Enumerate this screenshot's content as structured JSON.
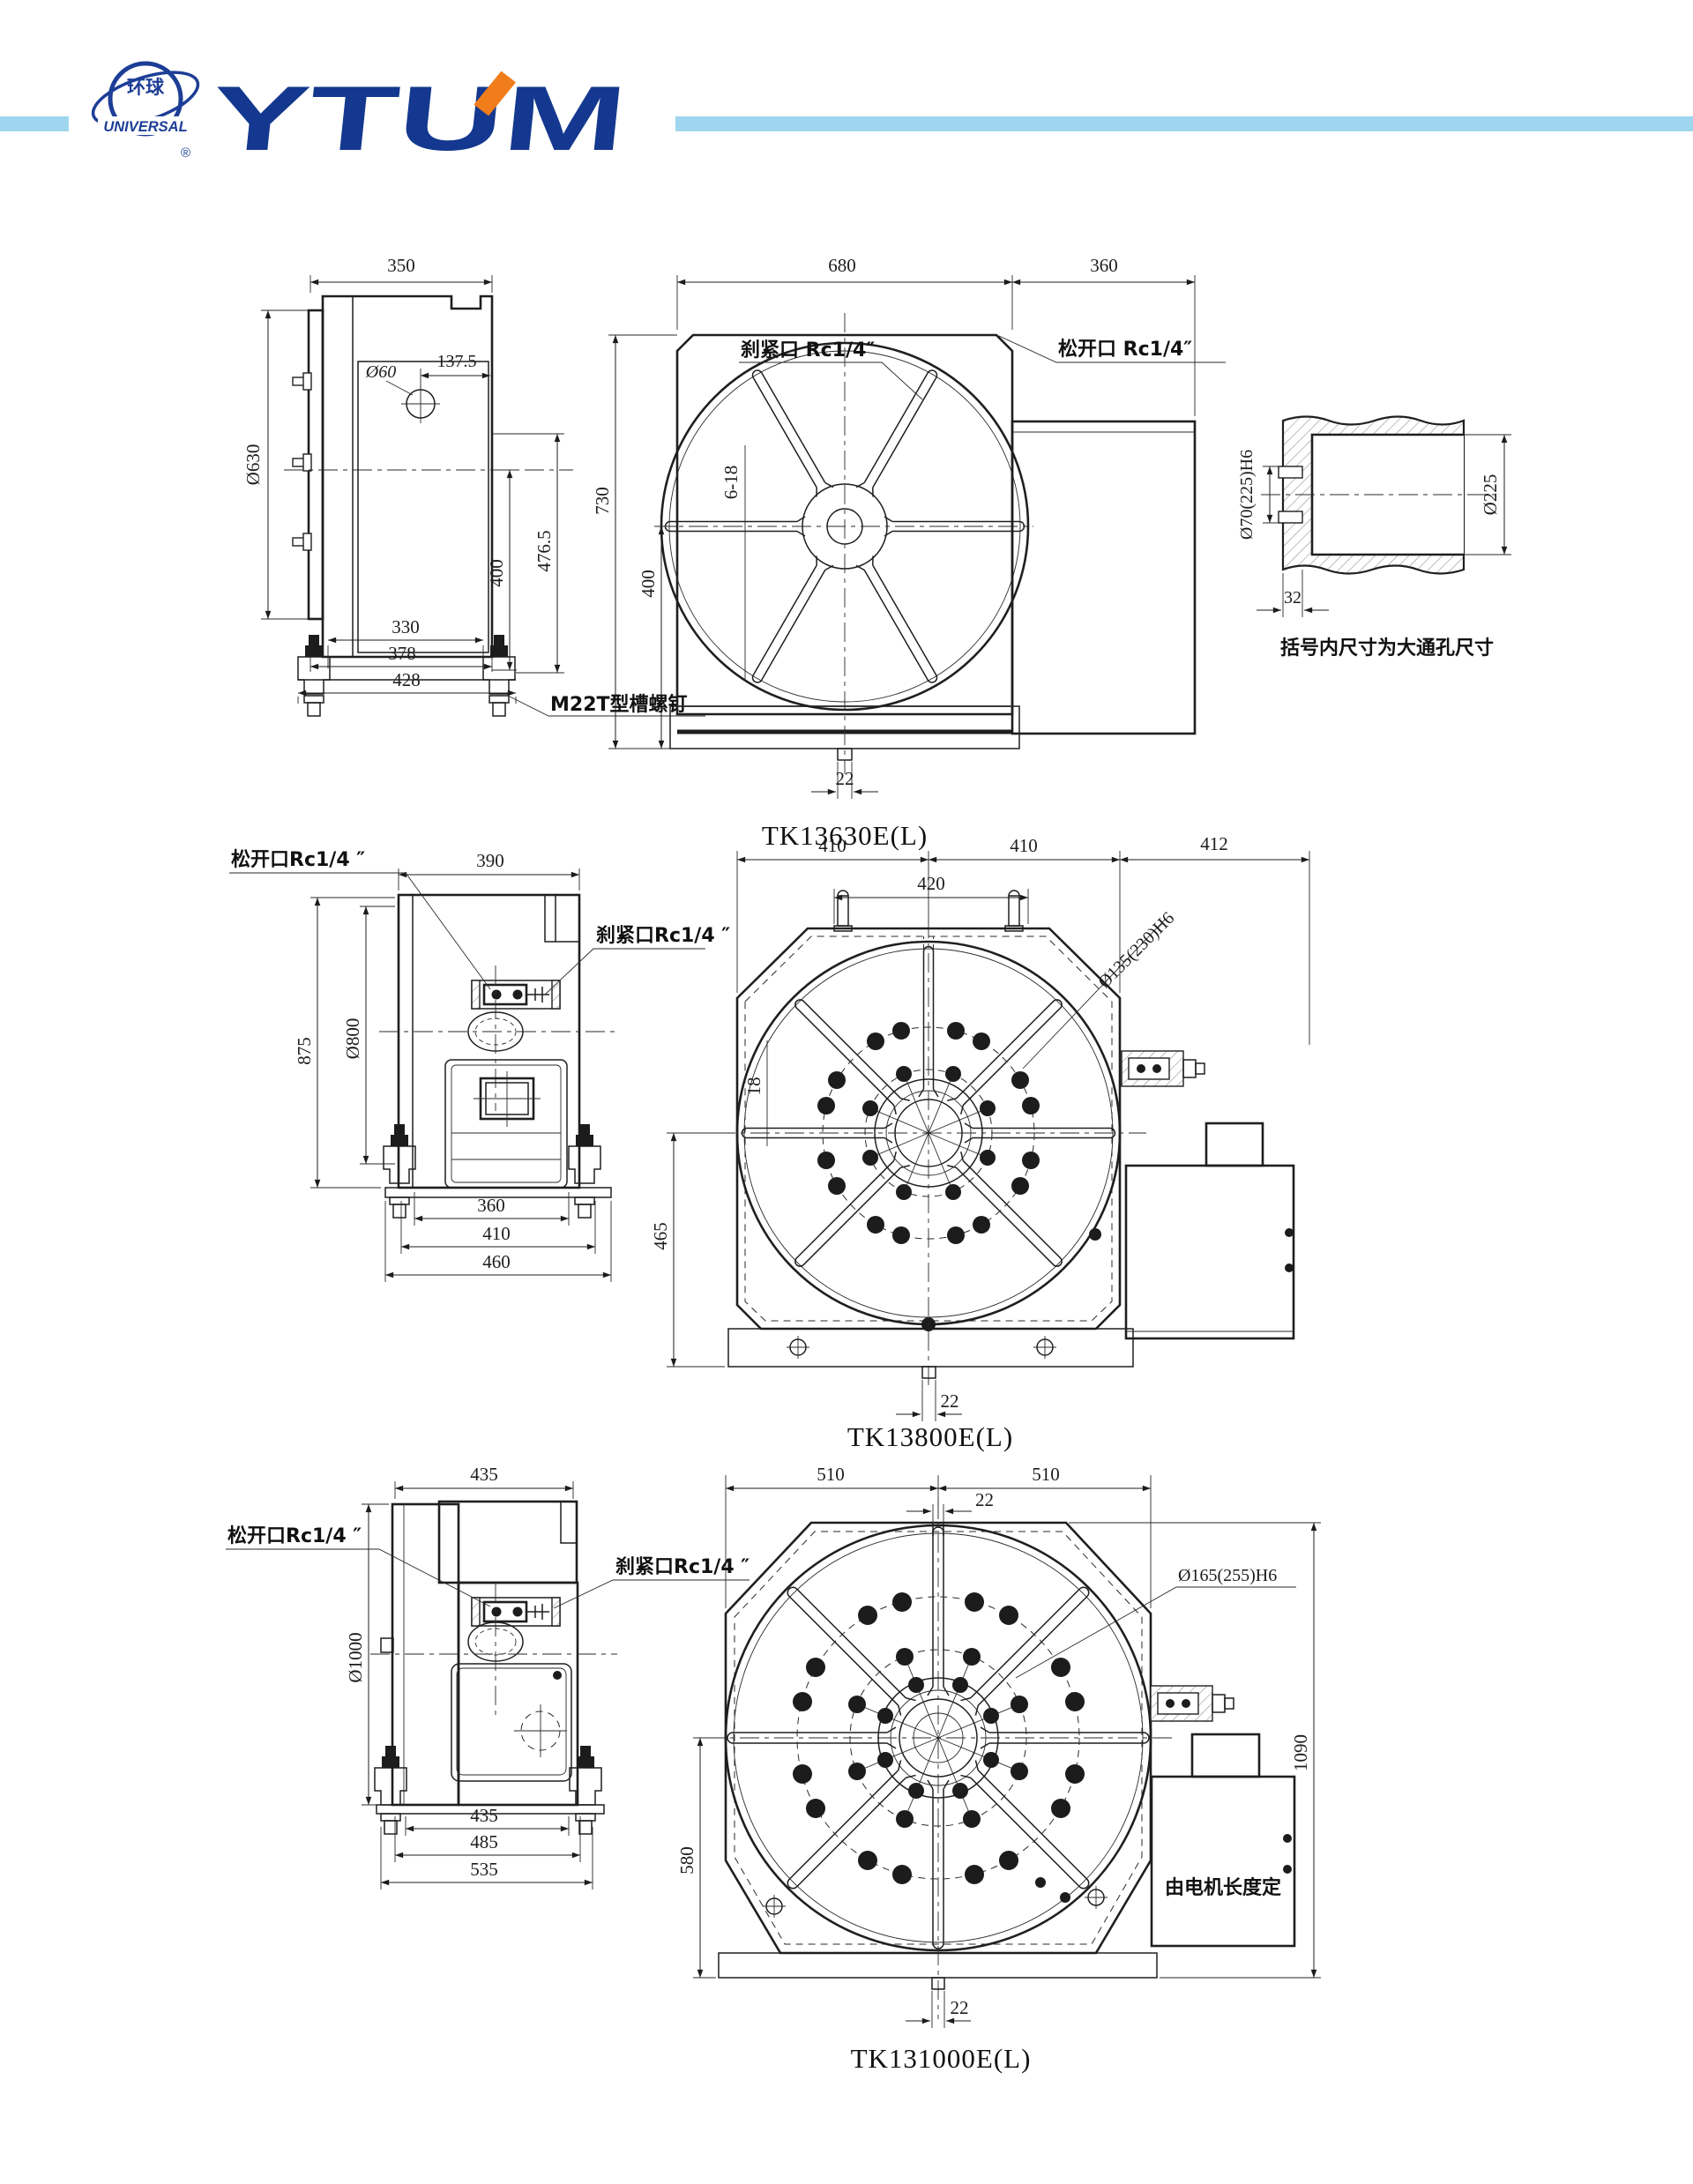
{
  "header": {
    "cn": "环球",
    "en": "UNIVERSAL",
    "reg": "®",
    "brand": "YTUM",
    "accent_blue": "#14388f",
    "accent_orange": "#f07c1a",
    "bar_color": "#9fd6ef"
  },
  "note": "括号内尺寸为大通孔尺寸",
  "d1": {
    "title": "TK13630E(L)",
    "s_w": "350",
    "s_dia": "Ø630",
    "s_off": "137.5",
    "s_bore": "Ø60",
    "s_h400": "400",
    "s_h476": "476.5",
    "s_b330": "330",
    "s_b378": "378",
    "s_b428": "428",
    "s_screw": "M22T型槽螺钉",
    "f_w680": "680",
    "f_w360": "360",
    "f_slots": "6-18",
    "f_h730": "730",
    "f_h400": "400",
    "f_s22": "22",
    "f_brake": "刹紧口 Rc1/4″",
    "f_release": "松开口 Rc1/4″",
    "dt_bore": "Ø70(225)H6",
    "dt_dia": "Ø225",
    "dt_32": "32"
  },
  "d2": {
    "title": "TK13800E(L)",
    "s_w": "390",
    "s_h": "875",
    "s_dia": "Ø800",
    "s_b360": "360",
    "s_b410": "410",
    "s_b460": "460",
    "s_release": "松开口Rc1/4 ″",
    "s_brake": "刹紧口Rc1/4 ″",
    "f_w410a": "410",
    "f_w410b": "410",
    "f_w412": "412",
    "f_w420": "420",
    "f_bore": "Ø135(230)H6",
    "f_18": "18",
    "f_h465": "465",
    "f_s22": "22"
  },
  "d3": {
    "title": "TK131000E(L)",
    "s_w": "435",
    "s_dia": "Ø1000",
    "s_b435": "435",
    "s_b485": "485",
    "s_b535": "535",
    "s_release": "松开口Rc1/4 ″",
    "s_brake": "刹紧口Rc1/4 ″",
    "f_w510a": "510",
    "f_w510b": "510",
    "f_t22": "22",
    "f_bore": "Ø165(255)H6",
    "f_h580": "580",
    "f_h1090": "1090",
    "f_motor": "由电机长度定",
    "f_s22": "22"
  }
}
